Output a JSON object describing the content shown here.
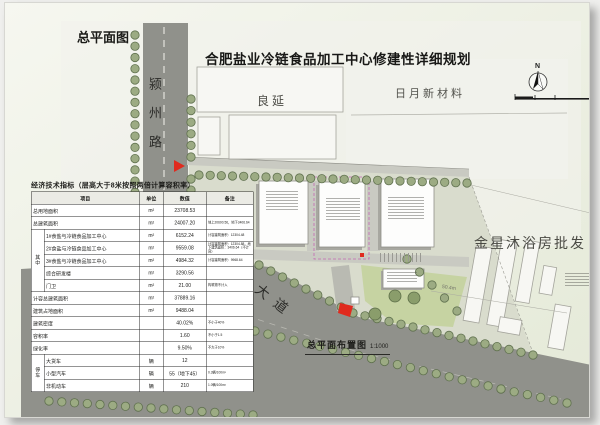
{
  "sheet": {
    "corner_title": "总平面图",
    "main_title": "合肥盐业冷链食品加工中心修建性详细规划",
    "caption": "总平面布置图",
    "caption_scale": "1:1000",
    "north_label": "N"
  },
  "roads": {
    "west": "颍州路",
    "south": "淮海大道"
  },
  "neighbors": {
    "northwest": "良延",
    "northeast": "日月新材料",
    "east": "金星沐浴房批发"
  },
  "annotations": {
    "east_dimension": "50.4m"
  },
  "colors": {
    "road": "#90918b",
    "roadlight": "#c9cac2",
    "tree": "#9cab83",
    "treering": "#60714f",
    "site": "#d9dccd",
    "lawn": "#c6d3a2",
    "building": "#fdfdfc",
    "outline": "#8f8f88",
    "shadow": "#a7a7a0",
    "red": "#e02a1e",
    "magenta": "#c468b4",
    "parcel": "#f1f2ec",
    "bg1": "#f6f7f0",
    "bg2": "#e4e9d7"
  },
  "table": {
    "title": "经济技术指标（层高大于8米按照两倍计算容积率）",
    "headers": [
      "项目",
      "单位",
      "数值",
      "备注"
    ],
    "rows": [
      {
        "group": "",
        "item": "总用地面积",
        "unit": "m²",
        "value": "23708.53",
        "note": ""
      },
      {
        "group": "",
        "item": "总建筑面积",
        "unit": "m²",
        "value": "24007.20",
        "note": "地上20600.56，地下3406.64"
      },
      {
        "group": "其中",
        "item": "1#食盐与冷链食品加工中心",
        "unit": "m²",
        "value": "6152.24",
        "note": "计容建筑面积：12304.48"
      },
      {
        "group": "其中",
        "item": "2#食盐与冷链食品加工中心",
        "unit": "m²",
        "value": "9559.08",
        "note": "计容建筑面积：12304.88，地下建筑面积：3406.64（不计容）"
      },
      {
        "group": "其中",
        "item": "3#食盐与冷链食品加工中心",
        "unit": "m²",
        "value": "4984.32",
        "note": "计容建筑面积：9968.64"
      },
      {
        "group": "其中",
        "item": "综合研发楼",
        "unit": "m²",
        "value": "3290.56",
        "note": ""
      },
      {
        "group": "其中",
        "item": "门卫",
        "unit": "m²",
        "value": "21.00",
        "note": "构筑物不计入"
      },
      {
        "group": "",
        "item": "计容总建筑面积",
        "unit": "m²",
        "value": "37889.16",
        "note": ""
      },
      {
        "group": "",
        "item": "建筑占地面积",
        "unit": "m²",
        "value": "9488.04",
        "note": ""
      },
      {
        "group": "",
        "item": "建筑密度",
        "unit": "",
        "value": "40.02%",
        "note": "不小于40%"
      },
      {
        "group": "",
        "item": "容积率",
        "unit": "",
        "value": "1.60",
        "note": "不小于1.5"
      },
      {
        "group": "",
        "item": "绿化率",
        "unit": "",
        "value": "9.50%",
        "note": "不大于10%"
      },
      {
        "group": "停车",
        "item": "大货车",
        "unit": "辆",
        "value": "12",
        "note": ""
      },
      {
        "group": "停车",
        "item": "小型汽车",
        "unit": "辆",
        "value": "55（地下45）",
        "note": "0.3辆/100m²"
      },
      {
        "group": "停车",
        "item": "非机动车",
        "unit": "辆",
        "value": "210",
        "note": "1.0辆/100m²"
      }
    ]
  }
}
